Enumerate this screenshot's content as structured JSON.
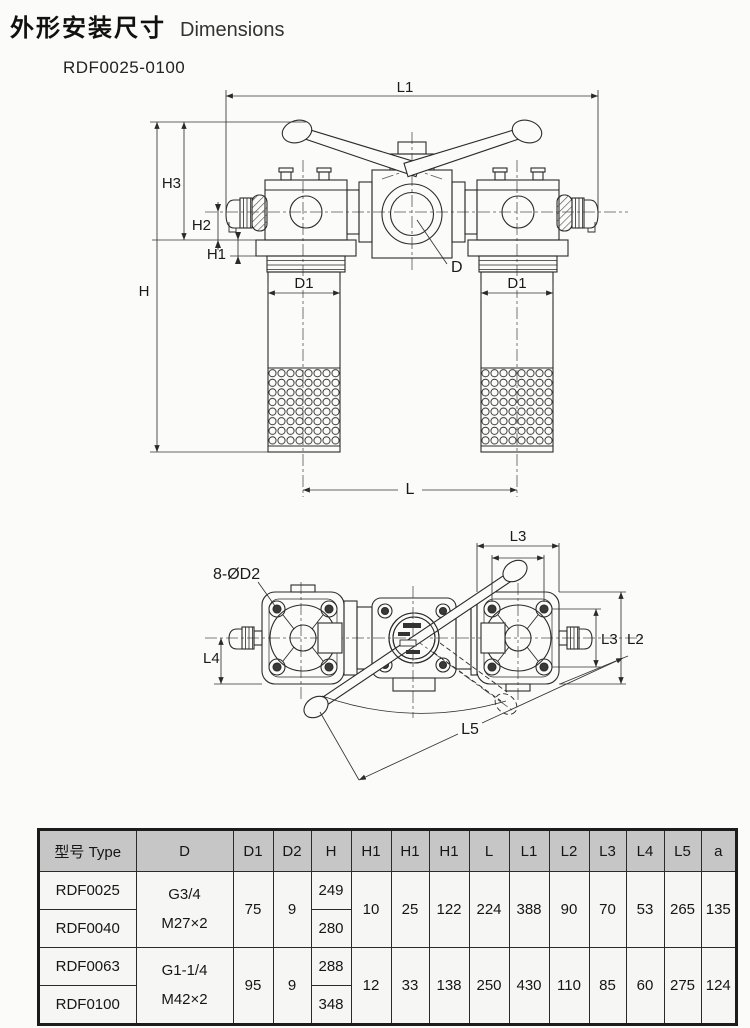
{
  "page": {
    "title_cn": "外形安装尺寸",
    "title_en": "Dimensions",
    "model_range": "RDF0025-0100"
  },
  "front_view": {
    "labels": {
      "L1": "L1",
      "H3": "H3",
      "H2": "H2",
      "H1": "H1",
      "H": "H",
      "D1_left": "D1",
      "D1_right": "D1",
      "D": "D",
      "L": "L"
    }
  },
  "top_view": {
    "labels": {
      "bolt_callout": "8-ØD2",
      "L3_top": "L3",
      "L3_right": "L3",
      "L2": "L2",
      "L4": "L4",
      "L5": "L5"
    }
  },
  "table": {
    "headers": [
      "型号 Type",
      "D",
      "D1",
      "D2",
      "H",
      "H1",
      "H1",
      "H1",
      "L",
      "L1",
      "L2",
      "L3",
      "L4",
      "L5",
      "a"
    ],
    "groups": [
      {
        "models": [
          "RDF0025",
          "RDF0040"
        ],
        "D": [
          "G3/4",
          "M27×2"
        ],
        "D1": "75",
        "D2": "9",
        "H": [
          "249",
          "280"
        ],
        "H1a": "10",
        "H1b": "25",
        "H1c": "122",
        "L": "224",
        "L1": "388",
        "L2": "90",
        "L3": "70",
        "L4": "53",
        "L5": "265",
        "a": "135"
      },
      {
        "models": [
          "RDF0063",
          "RDF0100"
        ],
        "D": [
          "G1-1/4",
          "M42×2"
        ],
        "D1": "95",
        "D2": "9",
        "H": [
          "288",
          "348"
        ],
        "H1a": "12",
        "H1b": "33",
        "H1c": "138",
        "L": "250",
        "L1": "430",
        "L2": "110",
        "L3": "85",
        "L4": "60",
        "L5": "275",
        "a": "124"
      }
    ]
  }
}
